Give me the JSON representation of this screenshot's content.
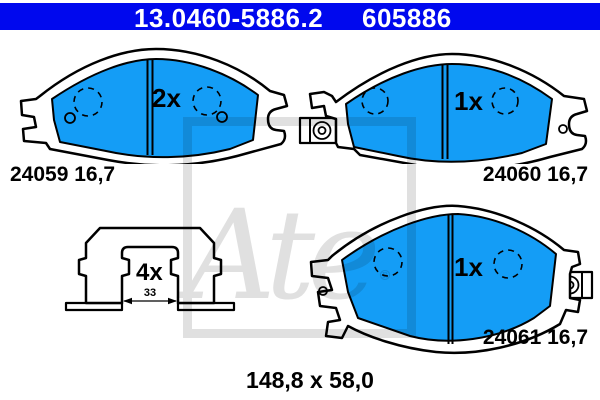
{
  "header": {
    "catalog_number": "13.0460-5886.2",
    "reference_number": "605886"
  },
  "parts": {
    "pad_left_outer": {
      "quantity": "2x",
      "label": "24059 16,7"
    },
    "pad_right_outer": {
      "quantity": "1x",
      "label": "24060 16,7"
    },
    "pad_inner": {
      "quantity": "1x",
      "label": "24061 16,7"
    },
    "fitting_clip": {
      "quantity": "4x",
      "inner_width_mm": "33"
    }
  },
  "footer": {
    "pad_dimensions": "148,8 x 58,0"
  },
  "watermark": {
    "brand_script": "Ate",
    "registered_mark": "®"
  },
  "colors": {
    "header_bg": "#0008EE",
    "pad_fill": "#149DF6",
    "outline": "#000000",
    "watermark_gray": "#E0E0E0"
  }
}
